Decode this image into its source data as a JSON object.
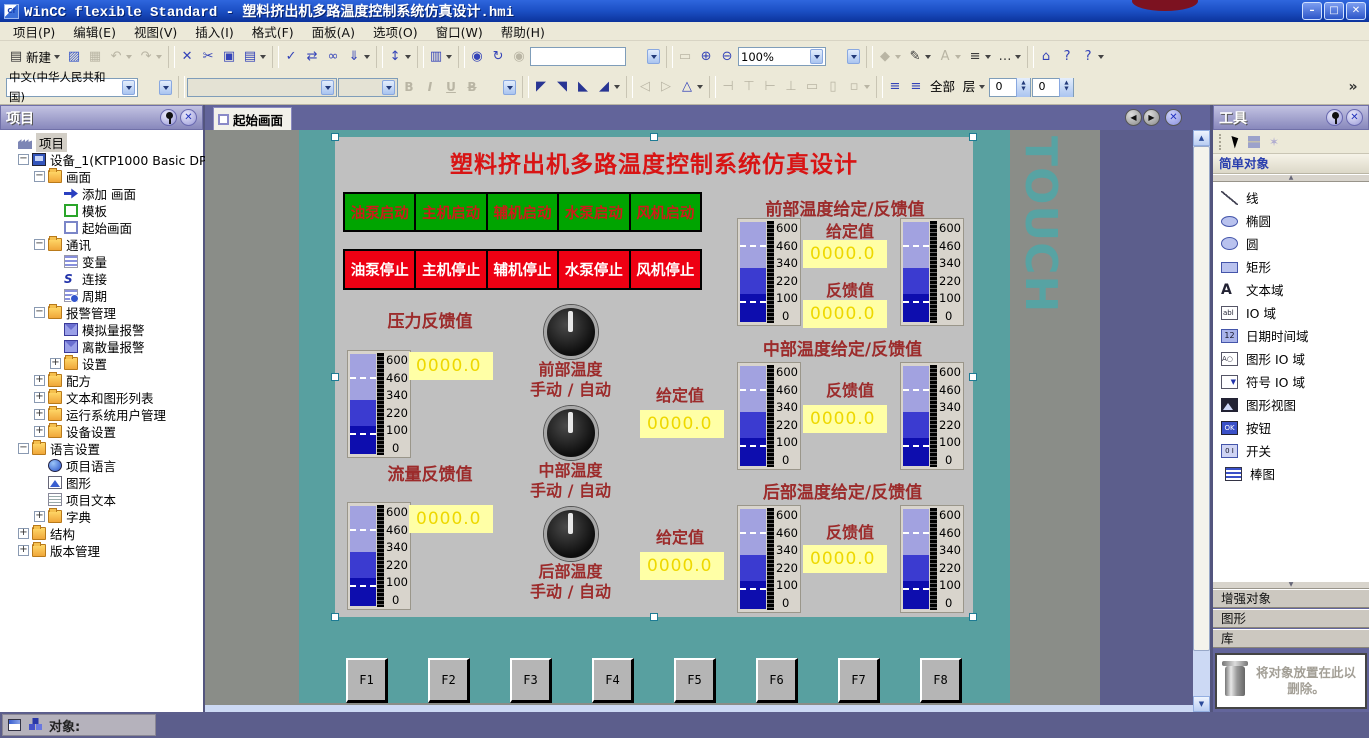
{
  "window": {
    "title": "WinCC flexible Standard - 塑料挤出机多路温度控制系统仿真设计.hmi"
  },
  "menu": {
    "items": [
      "项目(P)",
      "编辑(E)",
      "视图(V)",
      "插入(I)",
      "格式(F)",
      "面板(A)",
      "选项(O)",
      "窗口(W)",
      "帮助(H)"
    ]
  },
  "toolbar": {
    "row1": [
      {
        "n": "new-button",
        "c": "en",
        "g": "▤",
        "label": "新建",
        "dd": "y"
      },
      {
        "n": "open-button",
        "c": "en org",
        "g": "▨"
      },
      {
        "n": "save-button",
        "c": "dis",
        "g": "▦"
      },
      {
        "n": "undo-button",
        "c": "dis",
        "g": "↶",
        "dd": "y"
      },
      {
        "n": "redo-button",
        "c": "dis",
        "g": "↷",
        "dd": "y"
      },
      {
        "c": "sep"
      },
      {
        "n": "delete-button",
        "c": "en blue",
        "g": "✕"
      },
      {
        "n": "cut-button",
        "c": "en blue",
        "g": "✂"
      },
      {
        "n": "copy-button",
        "c": "en blue",
        "g": "▣"
      },
      {
        "n": "paste-button",
        "c": "en blue",
        "g": "▤",
        "dd": "y"
      },
      {
        "c": "sep"
      },
      {
        "n": "check-consistency-button",
        "c": "en blue",
        "g": "✓"
      },
      {
        "n": "start-runtime-button",
        "c": "en blue",
        "g": "⇄"
      },
      {
        "n": "preview-button",
        "c": "en blue",
        "g": "∞"
      },
      {
        "n": "transfer-button",
        "c": "en blue",
        "g": "⇓",
        "dd": "y"
      },
      {
        "c": "sep"
      },
      {
        "n": "sort-button",
        "c": "en blue",
        "g": "↕",
        "dd": "y"
      },
      {
        "c": "sep"
      },
      {
        "n": "cross-reference-button",
        "c": "en blue",
        "g": "▥",
        "dd": "y"
      },
      {
        "c": "sep"
      },
      {
        "n": "find-button",
        "c": "en blue",
        "g": "◉"
      },
      {
        "n": "replace-button",
        "c": "en blue",
        "g": "↻"
      },
      {
        "n": "find-next-button",
        "c": "dis",
        "g": "◉"
      },
      {
        "n": "search-input",
        "c": "inputbox",
        "g": ""
      },
      {
        "n": "search-dd",
        "c": "ddonly",
        "g": "",
        "dd": "y"
      },
      {
        "c": "sep"
      },
      {
        "n": "zoom-region-button",
        "c": "dis",
        "g": "▭"
      },
      {
        "n": "zoom-in-button",
        "c": "en blue",
        "g": "⊕"
      },
      {
        "n": "zoom-out-button",
        "c": "en blue",
        "g": "⊖"
      },
      {
        "n": "zoom-combo",
        "c": "combo zoomw",
        "g": "100%",
        "dd": "y"
      },
      {
        "n": "zoom-dd",
        "c": "ddonly",
        "g": "",
        "dd": "y"
      },
      {
        "c": "sep"
      },
      {
        "n": "fill-color-button",
        "c": "dis",
        "g": "◆",
        "dd": "y"
      },
      {
        "n": "pen-color-button",
        "c": "en",
        "g": "✎",
        "dd": "y"
      },
      {
        "n": "font-color-button",
        "c": "dis",
        "g": "A",
        "dd": "y"
      },
      {
        "n": "line-width-button",
        "c": "en",
        "g": "≡",
        "dd": "y"
      },
      {
        "n": "line-style-button",
        "c": "en",
        "g": "…",
        "dd": "y"
      },
      {
        "c": "sep"
      },
      {
        "n": "help-book-button",
        "c": "en blue",
        "g": "⌂"
      },
      {
        "n": "help-index-button",
        "c": "en blue",
        "g": "?"
      },
      {
        "n": "help-search-button",
        "c": "en blue",
        "g": "?",
        "dd": "y"
      }
    ],
    "row2": [
      {
        "n": "language-combo",
        "c": "combo langw",
        "g": "中文(中华人民共和国)",
        "dd": "y"
      },
      {
        "n": "language-dd",
        "c": "ddonly",
        "g": "",
        "dd": "y"
      },
      {
        "c": "sep"
      },
      {
        "n": "font-combo",
        "c": "combo fontw disc",
        "g": "",
        "dd": "y"
      },
      {
        "n": "font-size-combo",
        "c": "combo sizew disc",
        "g": "",
        "dd": "y"
      },
      {
        "n": "bold-button",
        "c": "dis fmt",
        "g": "B"
      },
      {
        "n": "italic-button",
        "c": "dis fmt it",
        "g": "I"
      },
      {
        "n": "underline-button",
        "c": "dis fmt un",
        "g": "U"
      },
      {
        "n": "strike-button",
        "c": "dis fmt st",
        "g": "B"
      },
      {
        "n": "format-dd",
        "c": "ddonly",
        "g": "",
        "dd": "y"
      },
      {
        "c": "sep"
      },
      {
        "n": "rotate-tl-button",
        "c": "en navy",
        "g": "◤"
      },
      {
        "n": "rotate-tr-button",
        "c": "en navy",
        "g": "◥"
      },
      {
        "n": "rotate-bl-button",
        "c": "en navy",
        "g": "◣"
      },
      {
        "n": "rotate-br-button",
        "c": "en navy",
        "g": "◢",
        "dd": "y"
      },
      {
        "c": "sep"
      },
      {
        "n": "flip-h-button",
        "c": "dis",
        "g": "◁"
      },
      {
        "n": "flip-v-button",
        "c": "dis",
        "g": "▷"
      },
      {
        "n": "rotate-button",
        "c": "en blue",
        "g": "△",
        "dd": "y"
      },
      {
        "c": "sep"
      },
      {
        "n": "align-left-button",
        "c": "dis",
        "g": "⊣"
      },
      {
        "n": "align-top-button",
        "c": "dis",
        "g": "⊤"
      },
      {
        "n": "align-right-button",
        "c": "dis",
        "g": "⊢"
      },
      {
        "n": "align-bottom-button",
        "c": "dis",
        "g": "⊥"
      },
      {
        "n": "center-h-button",
        "c": "dis",
        "g": "▭"
      },
      {
        "n": "center-v-button",
        "c": "dis",
        "g": "▯"
      },
      {
        "n": "same-size-button",
        "c": "dis",
        "g": "▫",
        "dd": "y"
      },
      {
        "c": "sep"
      },
      {
        "n": "bring-forward-button",
        "c": "en blue",
        "g": "≡"
      },
      {
        "n": "send-backward-button",
        "c": "en blue",
        "g": "≡"
      },
      {
        "n": "layer-all-label",
        "c": "txt",
        "g": "全部"
      },
      {
        "n": "layer-select",
        "c": "txt",
        "g": "层",
        "dd": "y"
      },
      {
        "n": "layer-spinner-1",
        "c": "spin",
        "g": "0"
      },
      {
        "n": "layer-spinner-2",
        "c": "spin",
        "g": "0"
      },
      {
        "n": "toolbar-overflow",
        "c": "txt pushr",
        "g": "»"
      }
    ]
  },
  "project_panel": {
    "title": "项目",
    "tree": [
      {
        "t": "项目",
        "lvl": "lv0",
        "exp": "none",
        "icon": "i-fac",
        "hl": "hl"
      },
      {
        "t": "设备_1(KTP1000 Basic DP)",
        "lvl": "lv1",
        "exp": "minus",
        "icon": "i-dev"
      },
      {
        "t": "画面",
        "lvl": "lv2",
        "exp": "minus",
        "icon": "i-fold"
      },
      {
        "t": "添加 画面",
        "lvl": "lv3",
        "exp": "none",
        "icon": "i-add"
      },
      {
        "t": "模板",
        "lvl": "lv3",
        "exp": "none",
        "icon": "i-tpl"
      },
      {
        "t": "起始画面",
        "lvl": "lv3",
        "exp": "none",
        "icon": "i-scr"
      },
      {
        "t": "通讯",
        "lvl": "lv2",
        "exp": "minus",
        "icon": "i-fold"
      },
      {
        "t": "变量",
        "lvl": "lv3",
        "exp": "none",
        "icon": "i-tag"
      },
      {
        "t": "连接",
        "lvl": "lv3",
        "exp": "none",
        "icon": "i-con"
      },
      {
        "t": "周期",
        "lvl": "lv3",
        "exp": "none",
        "icon": "i-cyc"
      },
      {
        "t": "报警管理",
        "lvl": "lv2",
        "exp": "minus",
        "icon": "i-fold"
      },
      {
        "t": "模拟量报警",
        "lvl": "lv3",
        "exp": "none",
        "icon": "i-mail"
      },
      {
        "t": "离散量报警",
        "lvl": "lv3",
        "exp": "none",
        "icon": "i-mail"
      },
      {
        "t": "设置",
        "lvl": "lv3",
        "exp": "plus",
        "icon": "i-fold"
      },
      {
        "t": "配方",
        "lvl": "lv2",
        "exp": "plus",
        "icon": "i-fold"
      },
      {
        "t": "文本和图形列表",
        "lvl": "lv2",
        "exp": "plus",
        "icon": "i-fold"
      },
      {
        "t": "运行系统用户管理",
        "lvl": "lv2",
        "exp": "plus",
        "icon": "i-fold"
      },
      {
        "t": "设备设置",
        "lvl": "lv2",
        "exp": "plus",
        "icon": "i-fold"
      },
      {
        "t": "语言设置",
        "lvl": "lv1",
        "exp": "minus",
        "icon": "i-fold"
      },
      {
        "t": "项目语言",
        "lvl": "lv2",
        "exp": "none",
        "icon": "i-glb"
      },
      {
        "t": "图形",
        "lvl": "lv2",
        "exp": "none",
        "icon": "i-img"
      },
      {
        "t": "项目文本",
        "lvl": "lv2",
        "exp": "none",
        "icon": "i-txt"
      },
      {
        "t": "字典",
        "lvl": "lv2",
        "exp": "plus",
        "icon": "i-fold"
      },
      {
        "t": "结构",
        "lvl": "lv1",
        "exp": "plus",
        "icon": "i-fold"
      },
      {
        "t": "版本管理",
        "lvl": "lv1",
        "exp": "plus",
        "icon": "i-fold"
      }
    ]
  },
  "tabbar": {
    "tab_label": "起始画面"
  },
  "hmi": {
    "title": "塑料挤出机多路温度控制系统仿真设计",
    "start_buttons": [
      "油泵启动",
      "主机启动",
      "辅机启动",
      "水泵启动",
      "风机启动"
    ],
    "stop_buttons": [
      "油泵停止",
      "主机停止",
      "辅机停止",
      "水泵停止",
      "风机停止"
    ],
    "gauge_scale": [
      "600",
      "460",
      "340",
      "220",
      "100",
      "0"
    ],
    "pressure": {
      "label": "压力反馈值",
      "value": "0000.0"
    },
    "flow": {
      "label": "流量反馈值",
      "value": "0000.0"
    },
    "knobs": [
      {
        "l1": "前部温度",
        "l2": "手动 / 自动"
      },
      {
        "l1": "中部温度",
        "l2": "手动 / 自动"
      },
      {
        "l1": "后部温度",
        "l2": "手动 / 自动"
      }
    ],
    "front": {
      "header": "前部温度给定/反馈值",
      "sp_label": "给定值",
      "sp_value": "0000.0",
      "fb_label": "反馈值",
      "fb_value": "0000.0"
    },
    "middle": {
      "header": "中部温度给定/反馈值",
      "sp_label": "给定值",
      "sp_value": "0000.0",
      "fb_label": "反馈值",
      "fb_value": "0000.0"
    },
    "rear": {
      "header": "后部温度给定/反馈值",
      "sp_label": "给定值",
      "sp_value": "0000.0",
      "fb_label": "反馈值",
      "fb_value": "0000.0"
    },
    "fkeys": [
      "F1",
      "F2",
      "F3",
      "F4",
      "F5",
      "F6",
      "F7",
      "F8"
    ],
    "touch_text": "TOUCH"
  },
  "tools_panel": {
    "title": "工具",
    "section_simple": "简单对象",
    "items": [
      {
        "t": "线",
        "icon": "si-line",
        "n": "tool-line"
      },
      {
        "t": "椭圆",
        "icon": "si-ell",
        "n": "tool-ellipse"
      },
      {
        "t": "圆",
        "icon": "si-cir",
        "n": "tool-circle"
      },
      {
        "t": "矩形",
        "icon": "si-rect",
        "n": "tool-rectangle"
      },
      {
        "t": "文本域",
        "icon": "si-text",
        "n": "tool-text-field"
      },
      {
        "t": "IO 域",
        "icon": "si-io",
        "n": "tool-io-field"
      },
      {
        "t": "日期时间域",
        "icon": "si-dt",
        "n": "tool-datetime-field"
      },
      {
        "t": "图形 IO 域",
        "icon": "si-gio",
        "n": "tool-graphic-io-field"
      },
      {
        "t": "符号 IO 域",
        "icon": "si-sio",
        "n": "tool-symbolic-io-field"
      },
      {
        "t": "图形视图",
        "icon": "si-gv",
        "n": "tool-graphic-view"
      },
      {
        "t": "按钮",
        "icon": "si-btn",
        "n": "tool-button"
      },
      {
        "t": "开关",
        "icon": "si-sw",
        "n": "tool-switch"
      },
      {
        "t": "棒图",
        "icon": "si-bar",
        "n": "tool-bar-graph"
      }
    ],
    "sections_bottom": [
      "增强对象",
      "图形",
      "库"
    ],
    "trash_hint": "将对象放置在此以删除。"
  },
  "statusbar": {
    "object_label": "对象:"
  }
}
